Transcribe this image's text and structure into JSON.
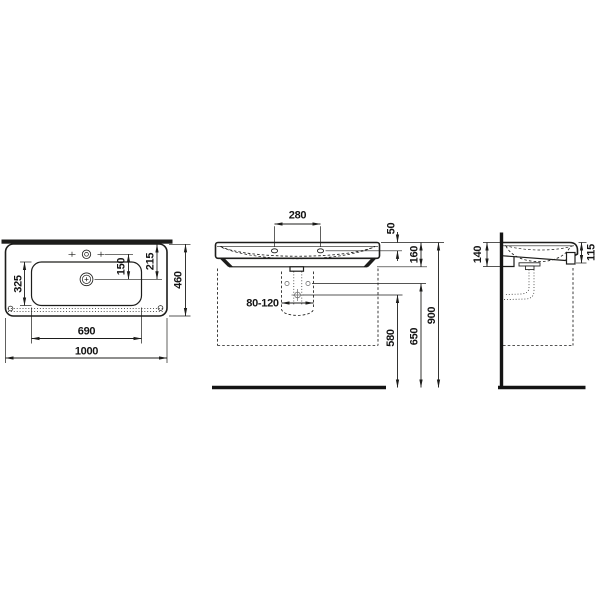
{
  "page": {
    "background": "#ffffff",
    "ink_color": "#1d1d1b"
  },
  "drawing_type": "washbasin technical dimension drawing, three orthographic views (plan, front elevation, side elevation)",
  "dimensions": {
    "top_view": {
      "basin_depth": "325",
      "tap_to_drain": "150",
      "edge_to_drain": "215",
      "overall_depth": "460",
      "basin_width": "690",
      "overall_width": "1000"
    },
    "front_view": {
      "tap_hole_spacing": "280",
      "rim_to_tap": "50",
      "body_height": "160",
      "trap_range": "80-120",
      "drain_height": "580",
      "fixing_height": "650",
      "rim_height": "900"
    },
    "side_view": {
      "depth_at_wall": "140",
      "front_edge_height": "115"
    }
  }
}
